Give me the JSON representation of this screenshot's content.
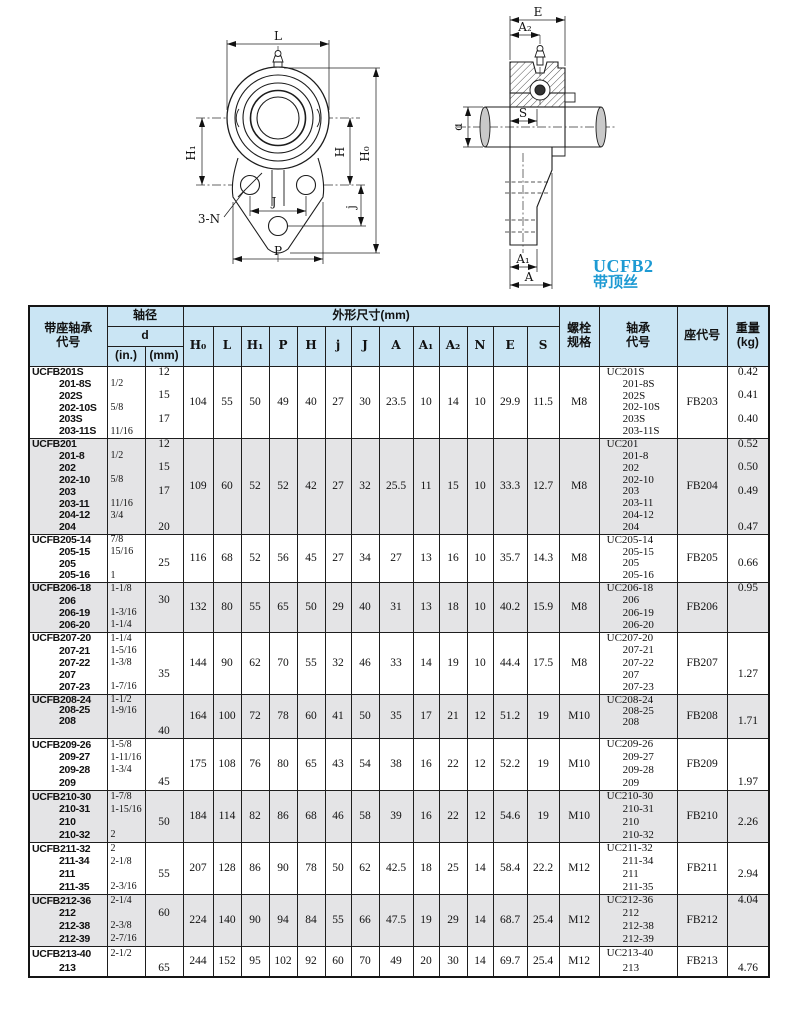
{
  "page": {
    "series_label": "UCFB2",
    "series_sublabel": "带顶丝"
  },
  "drawings": {
    "front": {
      "labels": {
        "L": "L",
        "H1": "H₁",
        "H": "H",
        "H0": "H₀",
        "J": "J",
        "j": "j",
        "P": "P",
        "N": "3-N"
      }
    },
    "side": {
      "labels": {
        "E": "E",
        "A2": "A₂",
        "d": "d",
        "S": "S",
        "A1": "A₁",
        "A": "A"
      }
    }
  },
  "table": {
    "headers": {
      "unit_code": "带座轴承\n代号",
      "shaft_dia": "轴径",
      "d": "d",
      "d_in": "(in.)",
      "d_mm": "(mm)",
      "dims_group": "外形尺寸(mm)",
      "dims": [
        "H₀",
        "L",
        "H₁",
        "P",
        "H",
        "j",
        "J",
        "A",
        "A₁",
        "A₂",
        "N",
        "E",
        "S"
      ],
      "dim_keys": [
        "H0",
        "L",
        "H1",
        "P",
        "H",
        "j",
        "J",
        "A",
        "A1",
        "A2",
        "N",
        "E",
        "S"
      ],
      "bolt": "螺栓\n规格",
      "bearing_code": "轴承\n代号",
      "housing_code": "座代号",
      "weight": "重量\n(kg)"
    },
    "rows": [
      {
        "h": 72,
        "shade": false,
        "codes": [
          "UCFB201S",
          "201-8S",
          "202S",
          "202-10S",
          "203S",
          "203-11S"
        ],
        "inches": [
          "",
          "1/2",
          "",
          "5/8",
          "",
          "11/16"
        ],
        "mm": [
          "12",
          "",
          "15",
          "",
          "17",
          ""
        ],
        "dims": [
          "104",
          "55",
          "50",
          "49",
          "40",
          "27",
          "30",
          "23.5",
          "10",
          "14",
          "10",
          "29.9",
          "11.5"
        ],
        "bolt": "M8",
        "bearing": [
          "UC201S",
          "201-8S",
          "202S",
          "202-10S",
          "203S",
          "203-11S"
        ],
        "housing": "FB203",
        "weights": [
          "0.42",
          "",
          "0.41",
          "",
          "0.40",
          ""
        ]
      },
      {
        "h": 96,
        "shade": true,
        "codes": [
          "UCFB201",
          "201-8",
          "202",
          "202-10",
          "203",
          "203-11",
          "204-12",
          "204"
        ],
        "inches": [
          "",
          "1/2",
          "",
          "5/8",
          "",
          "11/16",
          "3/4",
          ""
        ],
        "mm": [
          "12",
          "",
          "15",
          "",
          "17",
          "",
          "",
          "20"
        ],
        "dims": [
          "109",
          "60",
          "52",
          "52",
          "42",
          "27",
          "32",
          "25.5",
          "11",
          "15",
          "10",
          "33.3",
          "12.7"
        ],
        "bolt": "M8",
        "bearing": [
          "UC201",
          "201-8",
          "202",
          "202-10",
          "203",
          "203-11",
          "204-12",
          "204"
        ],
        "housing": "FB204",
        "weights": [
          "0.52",
          "",
          "0.50",
          "",
          "0.49",
          "",
          "",
          "0.47"
        ]
      },
      {
        "h": 48,
        "shade": false,
        "codes": [
          "UCFB205-14",
          "205-15",
          "205",
          "205-16"
        ],
        "inches": [
          "7/8",
          "15/16",
          "",
          "1"
        ],
        "mm": [
          "",
          "",
          "25",
          ""
        ],
        "dims": [
          "116",
          "68",
          "52",
          "56",
          "45",
          "27",
          "34",
          "27",
          "13",
          "16",
          "10",
          "35.7",
          "14.3"
        ],
        "bolt": "M8",
        "bearing": [
          "UC205-14",
          "205-15",
          "205",
          "205-16"
        ],
        "housing": "FB205",
        "weights": [
          "",
          "",
          "0.66",
          ""
        ]
      },
      {
        "h": 50,
        "shade": true,
        "codes": [
          "UCFB206-18",
          "206",
          "206-19",
          "206-20"
        ],
        "inches": [
          "1-1/8",
          "",
          "1-3/16",
          "1-1/4"
        ],
        "mm": [
          "",
          "30",
          "",
          ""
        ],
        "dims": [
          "132",
          "80",
          "55",
          "65",
          "50",
          "29",
          "40",
          "31",
          "13",
          "18",
          "10",
          "40.2",
          "15.9"
        ],
        "bolt": "M8",
        "bearing": [
          "UC206-18",
          "206",
          "206-19",
          "206-20"
        ],
        "housing": "FB206",
        "weights": [
          "0.95",
          "",
          "",
          ""
        ]
      },
      {
        "h": 62,
        "shade": false,
        "codes": [
          "UCFB207-20",
          "207-21",
          "207-22",
          "207",
          "207-23"
        ],
        "inches": [
          "1-1/4",
          "1-5/16",
          "1-3/8",
          "",
          "1-7/16"
        ],
        "mm": [
          "",
          "",
          "",
          "35",
          ""
        ],
        "dims": [
          "144",
          "90",
          "62",
          "70",
          "55",
          "32",
          "46",
          "33",
          "14",
          "19",
          "10",
          "44.4",
          "17.5"
        ],
        "bolt": "M8",
        "bearing": [
          "UC207-20",
          "207-21",
          "207-22",
          "207",
          "207-23"
        ],
        "housing": "FB207",
        "weights": [
          "",
          "",
          "",
          "1.27",
          ""
        ]
      },
      {
        "h": 44,
        "shade": true,
        "codes": [
          "UCFB208-24",
          "208-25",
          "208",
          ""
        ],
        "inches": [
          "1-1/2",
          "1-9/16",
          "",
          ""
        ],
        "mm": [
          "",
          "",
          "",
          "40"
        ],
        "dims": [
          "164",
          "100",
          "72",
          "78",
          "60",
          "41",
          "50",
          "35",
          "17",
          "21",
          "12",
          "51.2",
          "19"
        ],
        "bolt": "M10",
        "bearing": [
          "UC208-24",
          "208-25",
          "208",
          ""
        ],
        "housing": "FB208",
        "weights": [
          "",
          "",
          "1.71",
          ""
        ]
      },
      {
        "h": 52,
        "shade": false,
        "codes": [
          "UCFB209-26",
          "209-27",
          "209-28",
          "209"
        ],
        "inches": [
          "1-5/8",
          "1-11/16",
          "1-3/4",
          ""
        ],
        "mm": [
          "",
          "",
          "",
          "45"
        ],
        "dims": [
          "175",
          "108",
          "76",
          "80",
          "65",
          "43",
          "54",
          "38",
          "16",
          "22",
          "12",
          "52.2",
          "19"
        ],
        "bolt": "M10",
        "bearing": [
          "UC209-26",
          "209-27",
          "209-28",
          "209"
        ],
        "housing": "FB209",
        "weights": [
          "",
          "",
          "",
          "1.97"
        ]
      },
      {
        "h": 52,
        "shade": true,
        "codes": [
          "UCFB210-30",
          "210-31",
          "210",
          "210-32"
        ],
        "inches": [
          "1-7/8",
          "1-15/16",
          "",
          "2"
        ],
        "mm": [
          "",
          "",
          "50",
          ""
        ],
        "dims": [
          "184",
          "114",
          "82",
          "86",
          "68",
          "46",
          "58",
          "39",
          "16",
          "22",
          "12",
          "54.6",
          "19"
        ],
        "bolt": "M10",
        "bearing": [
          "UC210-30",
          "210-31",
          "210",
          "210-32"
        ],
        "housing": "FB210",
        "weights": [
          "",
          "",
          "2.26",
          ""
        ]
      },
      {
        "h": 52,
        "shade": false,
        "codes": [
          "UCFB211-32",
          "211-34",
          "211",
          "211-35"
        ],
        "inches": [
          "2",
          "2-1/8",
          "",
          "2-3/16"
        ],
        "mm": [
          "",
          "",
          "55",
          ""
        ],
        "dims": [
          "207",
          "128",
          "86",
          "90",
          "78",
          "50",
          "62",
          "42.5",
          "18",
          "25",
          "14",
          "58.4",
          "22.2"
        ],
        "bolt": "M12",
        "bearing": [
          "UC211-32",
          "211-34",
          "211",
          "211-35"
        ],
        "housing": "FB211",
        "weights": [
          "",
          "",
          "2.94",
          ""
        ]
      },
      {
        "h": 52,
        "shade": true,
        "codes": [
          "UCFB212-36",
          "212",
          "212-38",
          "212-39"
        ],
        "inches": [
          "2-1/4",
          "",
          "2-3/8",
          "2-7/16"
        ],
        "mm": [
          "",
          "60",
          "",
          ""
        ],
        "dims": [
          "224",
          "140",
          "90",
          "94",
          "84",
          "55",
          "66",
          "47.5",
          "19",
          "29",
          "14",
          "68.7",
          "25.4"
        ],
        "bolt": "M12",
        "bearing": [
          "UC212-36",
          "212",
          "212-38",
          "212-39"
        ],
        "housing": "FB212",
        "weights": [
          "4.04",
          "",
          "",
          ""
        ]
      },
      {
        "h": 30,
        "shade": false,
        "codes": [
          "UCFB213-40",
          "213"
        ],
        "inches": [
          "2-1/2",
          ""
        ],
        "mm": [
          "",
          "65"
        ],
        "dims": [
          "244",
          "152",
          "95",
          "102",
          "92",
          "60",
          "70",
          "49",
          "20",
          "30",
          "14",
          "69.7",
          "25.4"
        ],
        "bolt": "M12",
        "bearing": [
          "UC213-40",
          "213"
        ],
        "housing": "FB213",
        "weights": [
          "",
          "4.76"
        ]
      }
    ]
  }
}
